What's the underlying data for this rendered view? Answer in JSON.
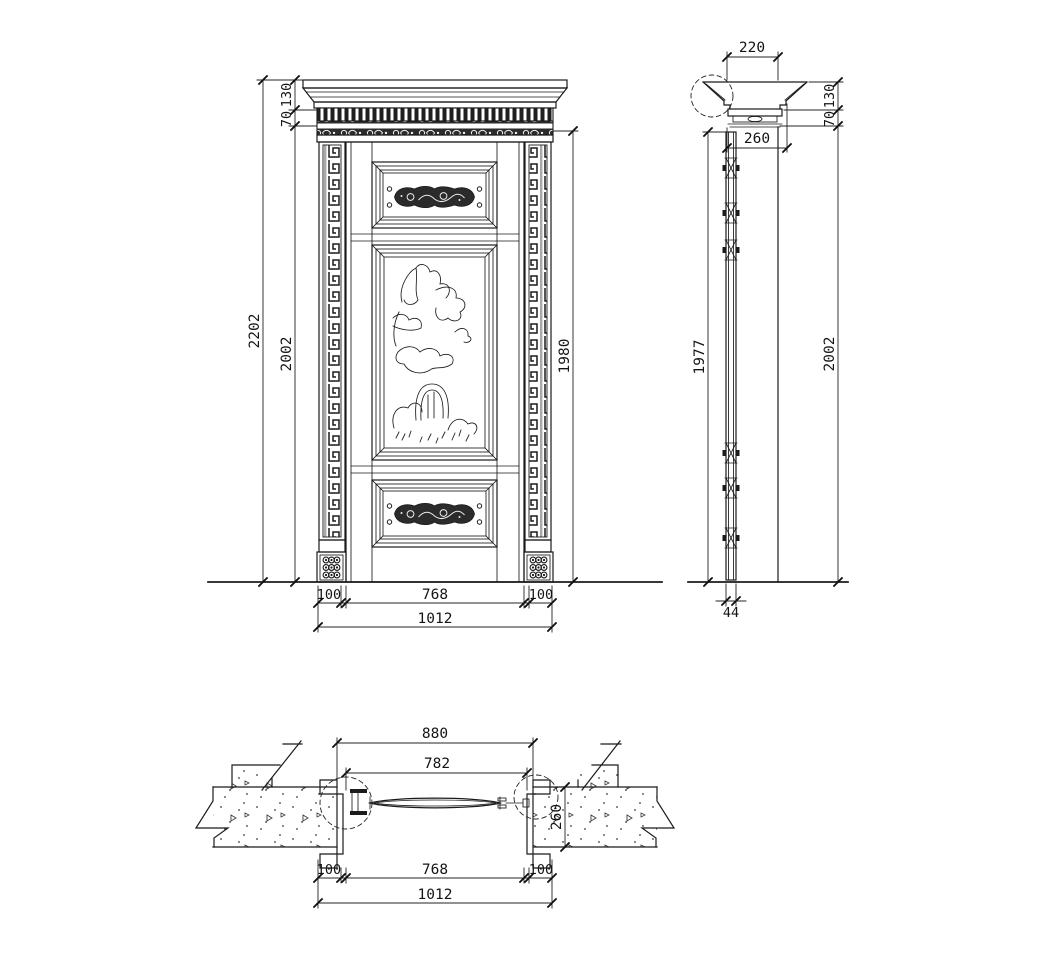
{
  "drawing": {
    "colors": {
      "line": "#1b1b1b",
      "background": "#ffffff",
      "carving_fill": "#2b2b2b"
    },
    "front_elevation": {
      "dims": {
        "overall_height": "2202",
        "frame_height": "2002",
        "cornice_height": "130",
        "frieze_height": "70",
        "opening_height": "1980",
        "left_pilaster_width": "100",
        "leaf_width": "768",
        "right_pilaster_width": "100",
        "overall_width": "1012"
      }
    },
    "side_elevation": {
      "dims": {
        "cornice_depth": "220",
        "cornice_height": "130",
        "frieze_height": "70",
        "head_depth": "260",
        "leaf_height": "1977",
        "frame_height": "2002",
        "leaf_thickness": "44"
      }
    },
    "plan_section": {
      "dims": {
        "frame_width": "880",
        "opening_width": "782",
        "left_jamb_width": "100",
        "leaf_width": "768",
        "right_jamb_width": "100",
        "overall_width": "1012",
        "wall_thickness": "260"
      }
    }
  }
}
